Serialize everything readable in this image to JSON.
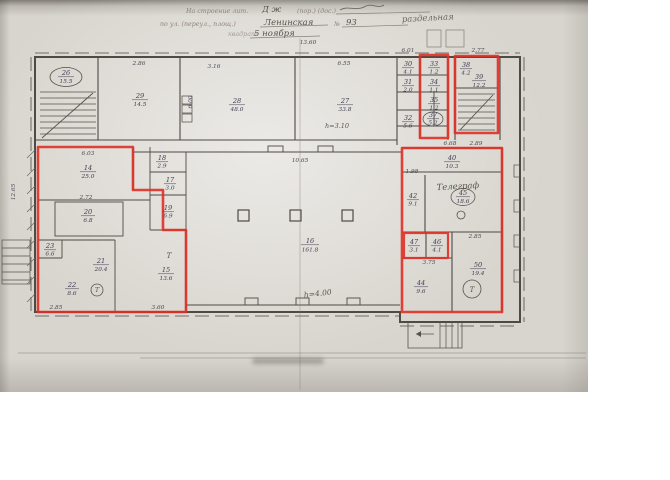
{
  "colors": {
    "red_outline": "#df3026",
    "ink": "#4e4a45"
  },
  "header": {
    "form_line1": "На строение лит.",
    "line1_value": "Д ж",
    "form_line1b": "(пор.) (дос.)",
    "form_line2": "по ул. (переул., площ.)",
    "line2_value": "Ленинская",
    "form_no": "№",
    "line2_number": "93",
    "form_line3": "квадрат",
    "line3_value": "5 ноября",
    "side_note": "раздельная"
  },
  "plan": {
    "handwritten": {
      "telegraph": "Телеграф",
      "hall_height": "h=4.00",
      "room27_height": "h=3.10",
      "t_mark": "Т"
    },
    "rooms": {
      "r26": {
        "num": "26",
        "area": "15.5"
      },
      "r29": {
        "num": "29",
        "area": "14.5"
      },
      "r28": {
        "num": "28",
        "area": "48.0"
      },
      "r27": {
        "num": "27",
        "area": "33.8"
      },
      "r30": {
        "num": "30",
        "area": "4.1"
      },
      "r31": {
        "num": "31",
        "area": "2.0"
      },
      "r32": {
        "num": "32",
        "area": "5.6"
      },
      "r33": {
        "num": "33",
        "area": "1.2"
      },
      "r34": {
        "num": "34",
        "area": "1.1"
      },
      "r35": {
        "num": "35",
        "area": "1.2"
      },
      "r37": {
        "num": "37",
        "area": "5.2"
      },
      "r38": {
        "num": "38",
        "area": "4.2"
      },
      "r39": {
        "num": "39",
        "area": "12.2"
      },
      "r14": {
        "num": "14",
        "area": "25.0"
      },
      "r18": {
        "num": "18",
        "area": "2.9"
      },
      "r17": {
        "num": "17",
        "area": "3.0"
      },
      "r19": {
        "num": "19",
        "area": "6.9"
      },
      "r20": {
        "num": "20",
        "area": "6.8"
      },
      "r23": {
        "num": "23",
        "area": "6.6"
      },
      "r22": {
        "num": "22",
        "area": "8.6"
      },
      "r21": {
        "num": "21",
        "area": "20.4"
      },
      "r15": {
        "num": "15",
        "area": "13.6"
      },
      "r16": {
        "num": "16",
        "area": "161.8"
      },
      "r40": {
        "num": "40",
        "area": "10.3"
      },
      "r42": {
        "num": "42",
        "area": "9.1"
      },
      "r45": {
        "num": "45",
        "area": "18.6"
      },
      "r47": {
        "num": "47",
        "area": "3.1"
      },
      "r46": {
        "num": "46",
        "area": "4.1"
      },
      "r44": {
        "num": "44",
        "area": "9.6"
      },
      "r50": {
        "num": "50",
        "area": "19.4"
      }
    },
    "dims": {
      "top_width": "13.60",
      "w286": "2.86",
      "w316": "3.16",
      "w655": "6.55",
      "w601": "6.01",
      "w277": "2.77",
      "w289": "2.89",
      "corridor": "10.65",
      "w603": "6.03",
      "w272": "2.72",
      "h600": "6.00",
      "h1265": "12.65",
      "w285a": "2.85",
      "w360": "3.60",
      "w668": "6.68",
      "w198": "1.98",
      "w285b": "2.85",
      "w375": "3.75"
    }
  }
}
